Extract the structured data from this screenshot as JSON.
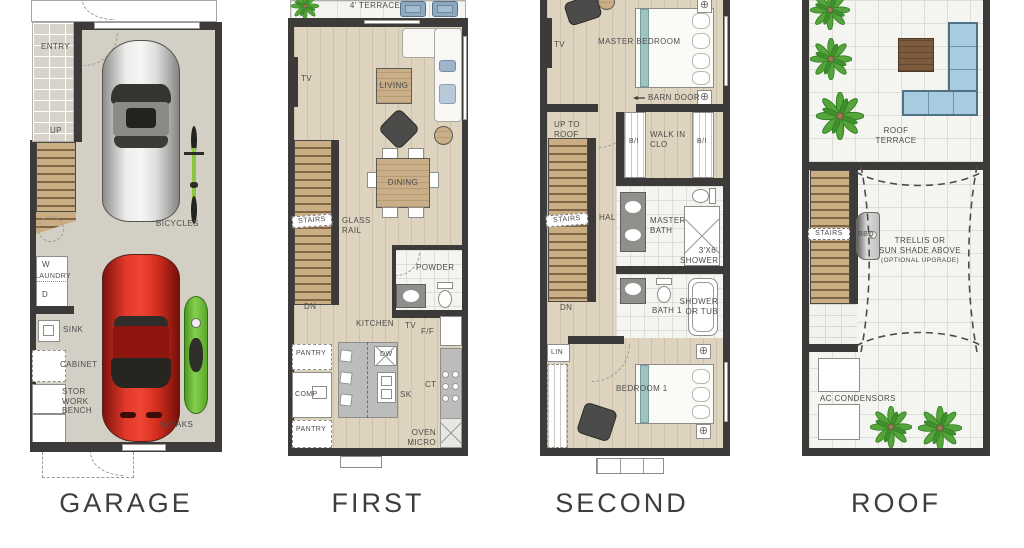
{
  "floors": {
    "garage": {
      "title": "GARAGE",
      "labels": {
        "entry": "ENTRY",
        "up": "UP",
        "bicycles": "BICYCLES",
        "washer": "W",
        "laundry": "LAUNDRY",
        "dryer": "D",
        "sink": "SINK",
        "cabinet": "CABINET",
        "stor_work_bench": "STOR\nWORK\nBENCH",
        "kayaks": "KAYAKS"
      }
    },
    "first": {
      "title": "FIRST",
      "labels": {
        "terrace": "4' TERRACE",
        "tv_living": "TV",
        "living": "LIVING",
        "dining": "DINING",
        "stairs": "STAIRS",
        "glass_rail": "GLASS\nRAIL",
        "dn": "DN",
        "powder": "POWDER",
        "kitchen": "KITCHEN",
        "tv_kitchen": "TV",
        "fridge": "F/F",
        "pantry_upper": "PANTRY",
        "dishwasher": "DW",
        "sink": "SK",
        "computer": "COMP",
        "cooktop": "CT",
        "pantry_lower": "PANTRY",
        "oven_micro": "OVEN\nMICRO"
      }
    },
    "second": {
      "title": "SECOND",
      "labels": {
        "tv": "TV",
        "master_bedroom": "MASTER BEDROOM",
        "barn_door": "BARN DOOR",
        "up_to_roof": "UP TO\nROOF",
        "bi_left": "B/I",
        "walk_in_clo": "WALK IN\nCLO",
        "bi_right": "B/I",
        "stairs": "STAIRS",
        "hall": "HALL",
        "master_bath": "MASTER\nBATH",
        "shower_3x6": "3'X6'\nSHOWER",
        "dn": "DN",
        "bath_1": "BATH 1",
        "shower_or_tub": "SHOWER\nOR TUB",
        "linen": "LIN",
        "bedroom_1": "BEDROOM 1"
      }
    },
    "roof": {
      "title": "ROOF",
      "labels": {
        "roof_terrace": "ROOF\nTERRACE",
        "stairs": "STAIRS",
        "bbq": "BBQ",
        "trellis": "TRELLIS OR\nSUN SHADE ABOVE",
        "trellis_note": "(OPTIONAL UPGRADE)",
        "ac_condensors": "AC CONDENSORS"
      }
    }
  },
  "colors": {
    "wall": "#3c3b39",
    "wood_floor": "#ded3bf",
    "garage_floor": "#d3cfc5",
    "tile": "#f4f4f1",
    "stair_wood": "#cbad83",
    "terrace_chair_blue": "#8ea8c0",
    "roof_sofa_blue": "#a9cbdf",
    "bed_accent_teal": "#a3c3c2",
    "car_red": "#d62f1f",
    "car_silver": "#e0e0de",
    "kayak_green": "#6cb83a",
    "palm_green": "#55a53c"
  }
}
